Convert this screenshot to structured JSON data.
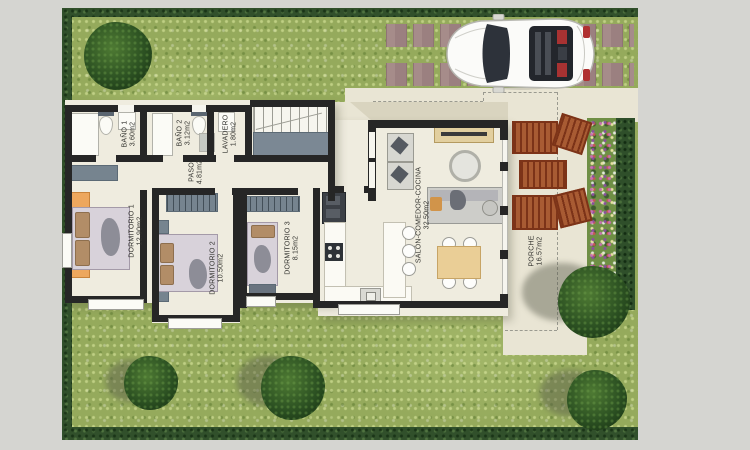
{
  "plan": {
    "rooms": [
      {
        "name": "BAÑO 1",
        "area": "3.60m2"
      },
      {
        "name": "BAÑO 2",
        "area": "3.12m2"
      },
      {
        "name": "LAVADERO",
        "area": "1.80m2"
      },
      {
        "name": "PASO",
        "area": "4.81m2"
      },
      {
        "name": "DORMITORIO 1",
        "area": "12.90m2"
      },
      {
        "name": "DORMITORIO 2",
        "area": "10.50m2"
      },
      {
        "name": "DORMITORIO 3",
        "area": "8.15m2"
      },
      {
        "name": "SALÓN-COMEDOR-COCINA",
        "area": "32.50m2"
      },
      {
        "name": "PORCHE",
        "area": "16.57m2"
      }
    ]
  },
  "site": {
    "objects": [
      "white-sports-car",
      "driveway-pavers",
      "hedge-border",
      "garden-trees",
      "sun-loungers",
      "flower-bed",
      "staircase"
    ],
    "colors": {
      "background": "#d5d5d1",
      "grass": "#95aa5c",
      "hedge": "#31502b",
      "path": "#e9e5d4",
      "floor": "#efecdf",
      "wall": "#262626",
      "lounger": "#95451f",
      "wardrobe": "#76848f",
      "accent_orange": "#eda75d",
      "car_body": "#f8f8f8",
      "slab": "#7b8894"
    }
  }
}
